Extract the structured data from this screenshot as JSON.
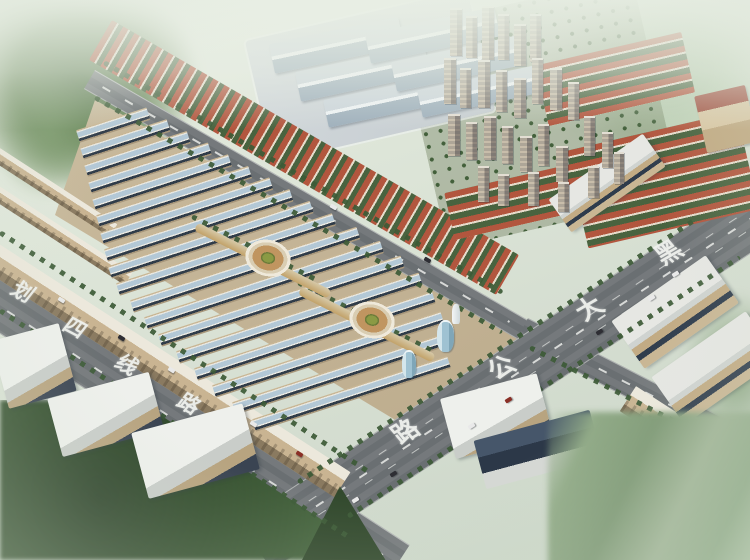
{
  "scene": {
    "description": "Bird's-eye architectural rendering of a wholesale market and residential development",
    "road_labels": {
      "left_road": {
        "text": "划四线路",
        "characters": [
          "划",
          "四",
          "线",
          "路"
        ]
      },
      "right_road": {
        "text": "黑大公路",
        "characters": [
          "黑",
          "大",
          "公",
          "路"
        ]
      }
    },
    "palette": {
      "haze": "#e7ede2",
      "ground": "#d3dccf",
      "market_roof_blue": "#b3c8d6",
      "market_shadow": "#303c49",
      "red_roof": "#b2563e",
      "warehouse_roof": "#ccd5db",
      "asphalt": "#6a6f72",
      "tree_green": "#3c5a36",
      "field_green": "#84a07a",
      "tan_wall": "#c9b492",
      "plaza_tan": "#c09560",
      "tower_wall": "#c8bdaa",
      "road_text": "#f1f3ef"
    }
  }
}
